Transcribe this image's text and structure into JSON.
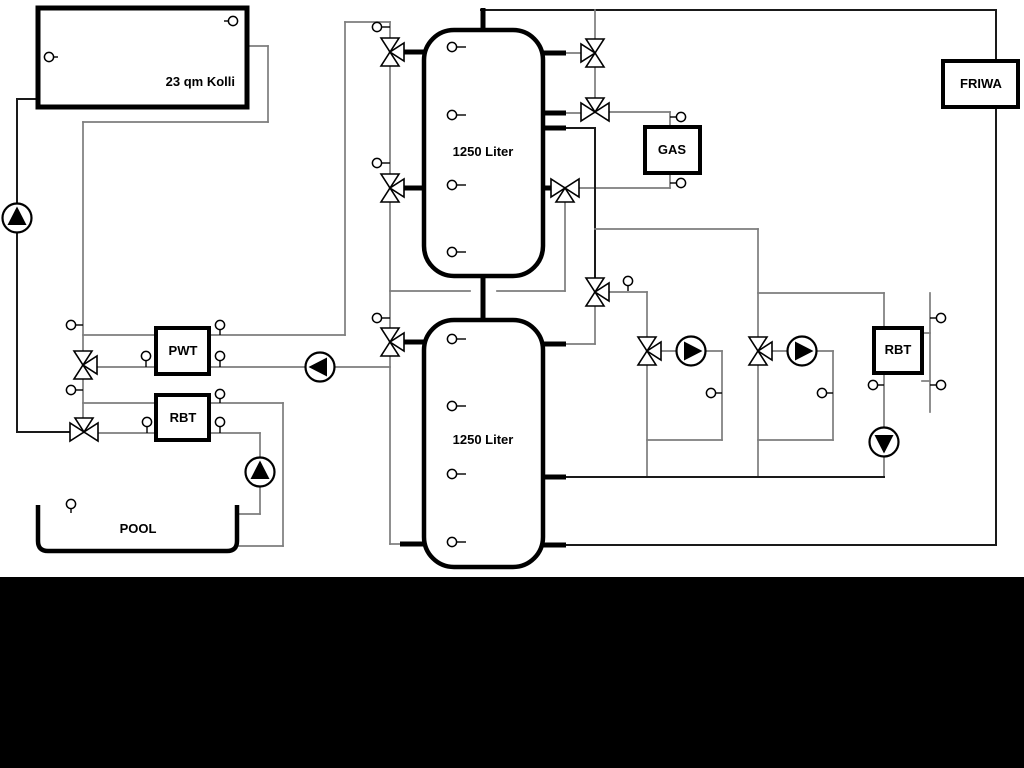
{
  "labels": {
    "collector": "23 qm Kolli",
    "tank1": "1250 Liter",
    "tank2": "1250 Liter",
    "pwt": "PWT",
    "rbt_left": "RBT",
    "gas": "GAS",
    "friwa": "FRIWA",
    "rbt_right": "RBT",
    "pool": "POOL"
  },
  "colors": {
    "background": "#ffffff",
    "pipe_gray": "#7d7d7d",
    "pipe_black": "#1a1a1a",
    "component_stroke": "#000000",
    "component_fill": "#ffffff",
    "bottom_bar": "#000000"
  },
  "bottom_bar": {
    "top": 577,
    "height": 191
  },
  "schematic": {
    "segments": [
      [
        17,
        99,
        40,
        99,
        "black"
      ],
      [
        17,
        99,
        17,
        204,
        "black"
      ],
      [
        17,
        232,
        17,
        432,
        "black"
      ],
      [
        17,
        432,
        70,
        432,
        "black"
      ],
      [
        247,
        46,
        268,
        46,
        "gray"
      ],
      [
        268,
        46,
        268,
        122,
        "gray"
      ],
      [
        83,
        122,
        268,
        122,
        "gray"
      ],
      [
        83,
        122,
        83,
        351,
        "gray"
      ],
      [
        83,
        379,
        83,
        418,
        "gray"
      ],
      [
        83,
        335,
        156,
        335,
        "gray"
      ],
      [
        209,
        335,
        345,
        335,
        "gray"
      ],
      [
        345,
        22,
        345,
        335,
        "gray"
      ],
      [
        345,
        22,
        390,
        22,
        "gray"
      ],
      [
        390,
        22,
        390,
        38,
        "gray"
      ],
      [
        390,
        66,
        390,
        174,
        "gray"
      ],
      [
        390,
        202,
        390,
        328,
        "gray"
      ],
      [
        390,
        356,
        390,
        544,
        "gray"
      ],
      [
        390,
        544,
        404,
        544,
        "gray"
      ],
      [
        97,
        367,
        156,
        367,
        "gray"
      ],
      [
        209,
        367,
        306,
        367,
        "gray"
      ],
      [
        334,
        367,
        390,
        367,
        "gray"
      ],
      [
        83,
        403,
        156,
        403,
        "gray"
      ],
      [
        209,
        403,
        283,
        403,
        "gray"
      ],
      [
        283,
        403,
        283,
        546,
        "gray"
      ],
      [
        239,
        546,
        283,
        546,
        "gray"
      ],
      [
        98,
        433,
        156,
        433,
        "gray"
      ],
      [
        209,
        433,
        260,
        433,
        "gray"
      ],
      [
        260,
        433,
        260,
        458,
        "gray"
      ],
      [
        260,
        486,
        260,
        514,
        "gray"
      ],
      [
        239,
        514,
        260,
        514,
        "gray"
      ],
      [
        390,
        291,
        470,
        291,
        "gray"
      ],
      [
        497,
        291,
        565,
        291,
        "gray"
      ],
      [
        565,
        202,
        565,
        291,
        "gray"
      ],
      [
        481,
        10,
        996,
        10,
        "black"
      ],
      [
        595,
        10,
        595,
        38,
        "gray"
      ],
      [
        595,
        67,
        595,
        98,
        "gray"
      ],
      [
        566,
        53,
        581,
        53,
        "gray"
      ],
      [
        564,
        113,
        581,
        113,
        "gray"
      ],
      [
        609,
        112,
        670,
        112,
        "gray"
      ],
      [
        670,
        112,
        670,
        127,
        "gray"
      ],
      [
        579,
        188,
        670,
        188,
        "gray"
      ],
      [
        670,
        173,
        670,
        188,
        "gray"
      ],
      [
        564,
        128,
        595,
        128,
        "black"
      ],
      [
        595,
        128,
        595,
        278,
        "black"
      ],
      [
        595,
        229,
        758,
        229,
        "gray"
      ],
      [
        609,
        292,
        647,
        292,
        "gray"
      ],
      [
        647,
        292,
        647,
        337,
        "gray"
      ],
      [
        595,
        306,
        595,
        344,
        "gray"
      ],
      [
        566,
        344,
        595,
        344,
        "gray"
      ],
      [
        647,
        365,
        647,
        477,
        "gray"
      ],
      [
        661,
        351,
        677,
        351,
        "gray"
      ],
      [
        705,
        351,
        722,
        351,
        "gray"
      ],
      [
        722,
        351,
        722,
        440,
        "gray"
      ],
      [
        647,
        440,
        722,
        440,
        "gray"
      ],
      [
        758,
        229,
        758,
        337,
        "gray"
      ],
      [
        758,
        365,
        758,
        477,
        "gray"
      ],
      [
        772,
        351,
        788,
        351,
        "gray"
      ],
      [
        816,
        351,
        833,
        351,
        "gray"
      ],
      [
        833,
        351,
        833,
        440,
        "gray"
      ],
      [
        758,
        440,
        833,
        440,
        "gray"
      ],
      [
        758,
        293,
        884,
        293,
        "gray"
      ],
      [
        884,
        293,
        884,
        328,
        "gray"
      ],
      [
        884,
        373,
        884,
        428,
        "gray"
      ],
      [
        884,
        456,
        884,
        477,
        "gray"
      ],
      [
        566,
        477,
        884,
        477,
        "black"
      ],
      [
        566,
        545,
        996,
        545,
        "black"
      ],
      [
        996,
        10,
        996,
        545,
        "black"
      ],
      [
        930,
        293,
        930,
        412,
        "gray"
      ],
      [
        922,
        333,
        930,
        333,
        "gray"
      ],
      [
        922,
        381,
        930,
        381,
        "gray"
      ]
    ],
    "stubs": [
      [
        483,
        8,
        483,
        31
      ],
      [
        483,
        274,
        483,
        322
      ],
      [
        403,
        52,
        426,
        52
      ],
      [
        403,
        188,
        426,
        188
      ],
      [
        541,
        53,
        566,
        53
      ],
      [
        541,
        113,
        566,
        113
      ],
      [
        541,
        128,
        566,
        128
      ],
      [
        541,
        188,
        553,
        188
      ],
      [
        402,
        342,
        426,
        342
      ],
      [
        400,
        544,
        426,
        544
      ],
      [
        541,
        344,
        566,
        344
      ],
      [
        541,
        477,
        566,
        477
      ],
      [
        541,
        545,
        566,
        545
      ]
    ],
    "valves": [
      [
        390,
        52,
        "E"
      ],
      [
        390,
        188,
        "E"
      ],
      [
        390,
        342,
        "E"
      ],
      [
        595,
        53,
        "W"
      ],
      [
        595,
        112,
        "N"
      ],
      [
        565,
        188,
        "S"
      ],
      [
        595,
        292,
        "E"
      ],
      [
        647,
        351,
        "E"
      ],
      [
        758,
        351,
        "E"
      ],
      [
        83,
        365,
        "E"
      ],
      [
        84,
        432,
        "N"
      ]
    ],
    "pumps": [
      [
        17,
        218,
        "N"
      ],
      [
        320,
        367,
        "W"
      ],
      [
        260,
        472,
        "N"
      ],
      [
        691,
        351,
        "E"
      ],
      [
        802,
        351,
        "E"
      ],
      [
        884,
        442,
        "S"
      ]
    ],
    "sensors": [
      [
        49,
        57,
        58,
        57
      ],
      [
        233,
        21,
        224,
        21
      ],
      [
        377,
        27,
        390,
        27
      ],
      [
        377,
        163,
        390,
        163
      ],
      [
        377,
        318,
        390,
        318
      ],
      [
        71,
        325,
        83,
        325
      ],
      [
        71,
        390,
        83,
        390
      ],
      [
        220,
        325,
        220,
        335
      ],
      [
        146,
        356,
        146,
        367
      ],
      [
        220,
        356,
        220,
        367
      ],
      [
        220,
        394,
        220,
        403
      ],
      [
        147,
        422,
        147,
        433
      ],
      [
        220,
        422,
        220,
        433
      ],
      [
        71,
        504,
        71,
        513
      ],
      [
        452,
        47,
        466,
        47
      ],
      [
        452,
        115,
        466,
        115
      ],
      [
        452,
        185,
        466,
        185
      ],
      [
        452,
        252,
        466,
        252
      ],
      [
        452,
        339,
        466,
        339
      ],
      [
        452,
        406,
        466,
        406
      ],
      [
        452,
        474,
        466,
        474
      ],
      [
        452,
        542,
        466,
        542
      ],
      [
        681,
        117,
        670,
        117
      ],
      [
        681,
        183,
        670,
        183
      ],
      [
        628,
        281,
        628,
        291
      ],
      [
        711,
        393,
        722,
        393
      ],
      [
        822,
        393,
        833,
        393
      ],
      [
        873,
        385,
        884,
        385
      ],
      [
        941,
        318,
        930,
        318
      ],
      [
        941,
        385,
        930,
        385
      ]
    ],
    "boxes": [
      {
        "name": "collector-box",
        "x": 38,
        "y": 8,
        "w": 209,
        "h": 99,
        "bw": 5,
        "rx": 0
      },
      {
        "name": "buffer-tank-1",
        "x": 424,
        "y": 30,
        "w": 119,
        "h": 246,
        "bw": 4.5,
        "rx": 30
      },
      {
        "name": "buffer-tank-2",
        "x": 424,
        "y": 320,
        "w": 119,
        "h": 247,
        "bw": 4.5,
        "rx": 30
      },
      {
        "name": "pwt-box",
        "x": 156,
        "y": 328,
        "w": 53,
        "h": 46,
        "bw": 4,
        "rx": 0
      },
      {
        "name": "rbt-left-box",
        "x": 156,
        "y": 395,
        "w": 53,
        "h": 45,
        "bw": 4,
        "rx": 0
      },
      {
        "name": "gas-box",
        "x": 645,
        "y": 127,
        "w": 55,
        "h": 46,
        "bw": 4,
        "rx": 0
      },
      {
        "name": "friwa-box",
        "x": 943,
        "y": 61,
        "w": 75,
        "h": 46,
        "bw": 4,
        "rx": 0
      },
      {
        "name": "rbt-right-box",
        "x": 874,
        "y": 328,
        "w": 48,
        "h": 45,
        "bw": 4,
        "rx": 0
      }
    ],
    "pool_path": "M38,505 L38,541 Q38,551 48,551 L227,551 Q237,551 237,541 L237,505"
  }
}
